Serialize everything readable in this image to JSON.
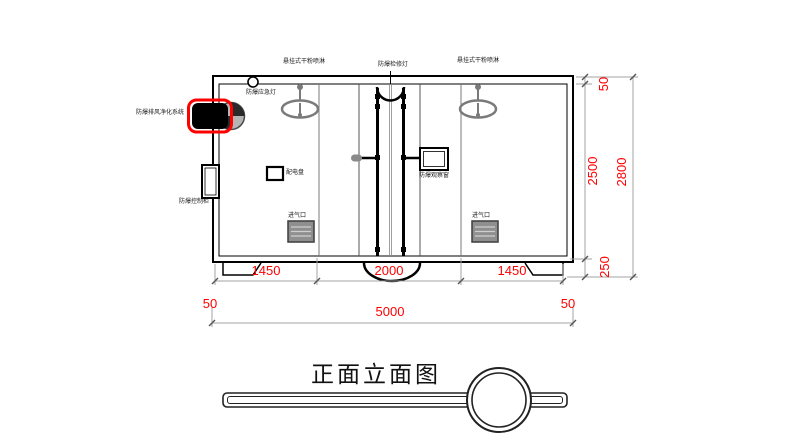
{
  "drawing_title": "正面立面图",
  "labels": {
    "hanging_sprinkler_left": "悬挂式干粉喷淋",
    "hanging_sprinkler_right": "悬挂式干粉喷淋",
    "inspection_lamp": "防爆检修灯",
    "emergency_lamp": "防爆应急灯",
    "exhaust_purification_system": "防爆排风净化系统",
    "control_cabinet": "防爆控制柜",
    "distribution_panel": "配电盘",
    "observation_window": "防爆观察窗",
    "air_inlet_left": "进气口",
    "air_inlet_right": "进气口"
  },
  "dimensions": {
    "bottom_left_segment": "1450",
    "bottom_center_segment": "2000",
    "bottom_right_segment": "1450",
    "bottom_total": "5000",
    "wall_thickness_left": "50",
    "wall_thickness_right": "50",
    "right_roof": "50",
    "right_body_height": "2500",
    "right_base_height": "250",
    "right_total_height": "2800"
  },
  "colors": {
    "dimension_text": "#ff0000",
    "highlight_outline": "#ff0000",
    "primary_line": "#000000",
    "secondary_line": "#808080"
  }
}
